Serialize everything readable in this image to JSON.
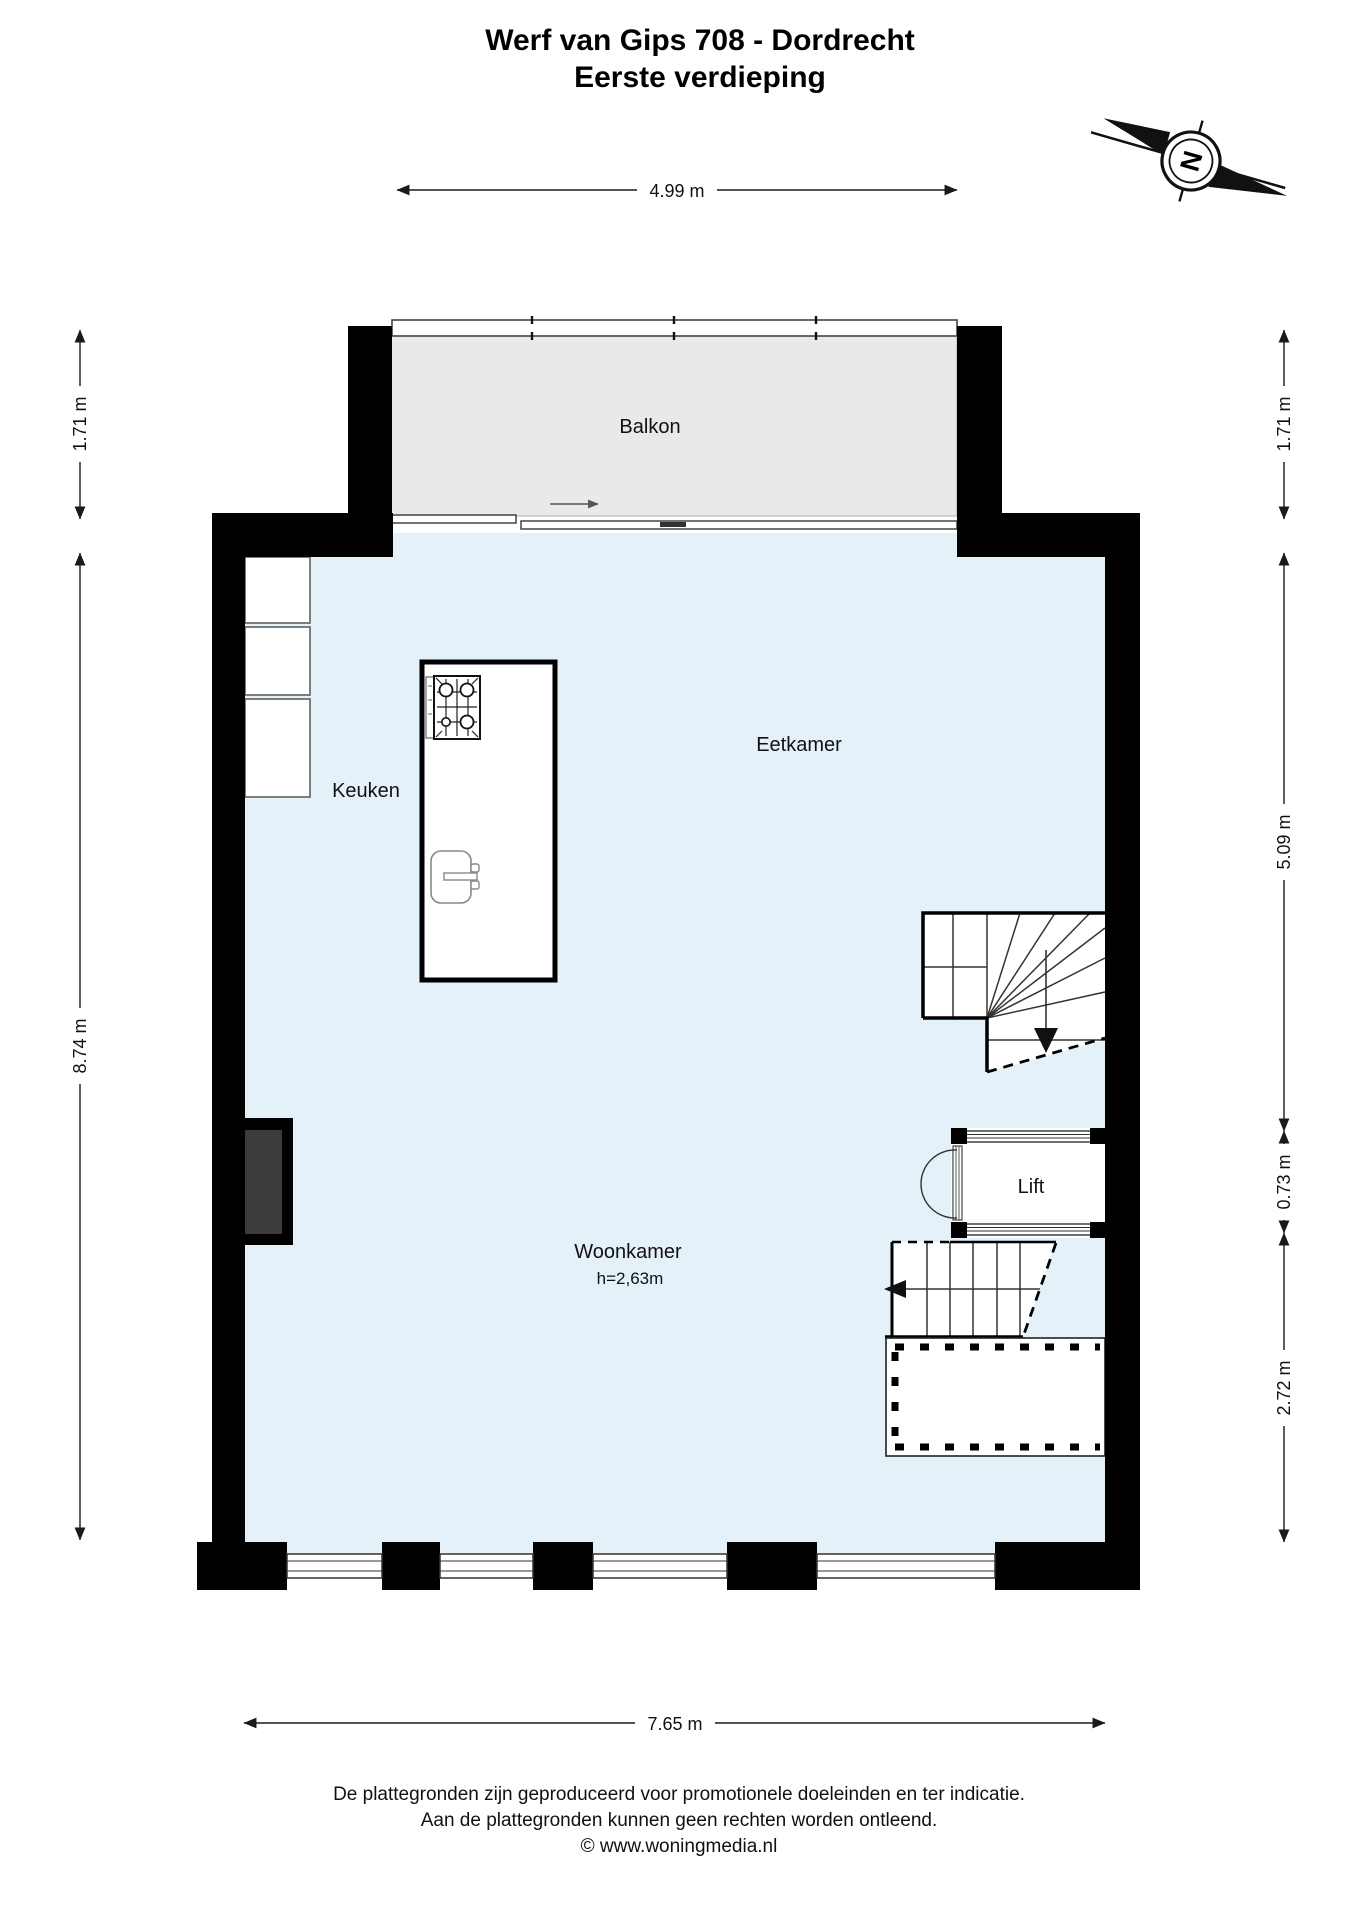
{
  "title": {
    "line1": "Werf van Gips 708 - Dordrecht",
    "line2": "Eerste verdieping"
  },
  "compass": {
    "north_label": "N"
  },
  "rooms": {
    "balkon": "Balkon",
    "eetkamer": "Eetkamer",
    "keuken": "Keuken",
    "woonkamer": "Woonkamer",
    "woonkamer_ceiling_height": "h=2,63m",
    "lift": "Lift"
  },
  "dimensions": {
    "top_balcony_width": "4.99 m",
    "left_balcony_depth": "1.71 m",
    "left_main_depth": "8.74 m",
    "right_balcony_depth": "1.71 m",
    "right_upper": "5.09 m",
    "right_middle": "0.73 m",
    "right_lower": "2.72 m",
    "bottom_width": "7.65 m"
  },
  "footer": {
    "line1": "De plattegronden zijn geproduceerd voor promotionele doeleinden en ter indicatie.",
    "line2": "Aan de plattegronden kunnen geen rechten worden ontleend.",
    "line3": "© www.woningmedia.nl"
  },
  "colors": {
    "floor": "#e4f1f8",
    "balcony": "#e9e9e9",
    "wall": "#000000",
    "shaft_fill": "#3b3b3b",
    "line": "#333333"
  }
}
